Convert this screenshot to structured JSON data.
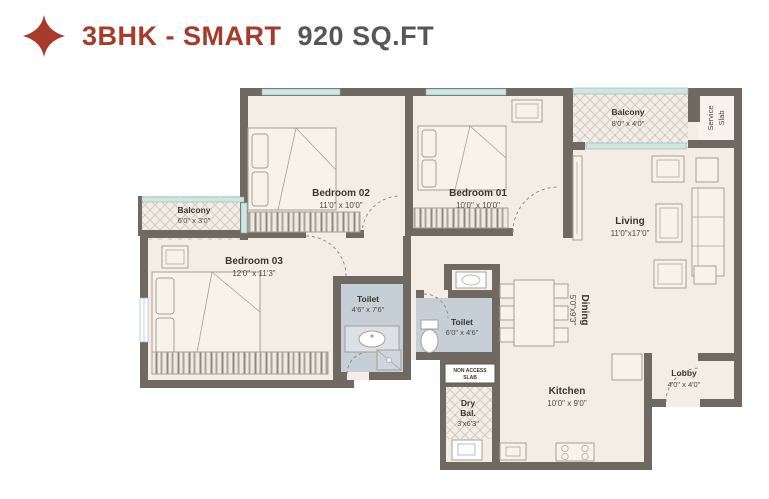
{
  "header": {
    "title_primary": "3BHK - SMART",
    "title_secondary": "920 SQ.FT",
    "accent_color": "#A63A2B",
    "secondary_text_color": "#55565A",
    "logo_icon": "sparkle-diamond"
  },
  "floorplan": {
    "colors": {
      "wall": "#6f6962",
      "floor": "#f4ede6",
      "toilet_floor": "#c6cfd6",
      "window": "#cfe6e3",
      "furniture_line": "#a79f94"
    },
    "rooms": {
      "bedroom02": {
        "name": "Bedroom 02",
        "dim": "11'0\" x 10'0\""
      },
      "bedroom01": {
        "name": "Bedroom 01",
        "dim": "10'0\" x 10'0\""
      },
      "bedroom03": {
        "name": "Bedroom 03",
        "dim": "12'0\" x 11'3\""
      },
      "living": {
        "name": "Living",
        "dim": "11'0\"x17'0\""
      },
      "dining": {
        "name": "Dining",
        "dim": "5'0\"x9'3\""
      },
      "kitchen": {
        "name": "Kitchen",
        "dim": "10'0\" x 9'0\""
      },
      "toilet1": {
        "name": "Toilet",
        "dim": "4'6\" x 7'6\""
      },
      "toilet2": {
        "name": "Toilet",
        "dim": "6'0\" x 4'6\""
      },
      "balcony_left": {
        "name": "Balcony",
        "dim": "6'0\" x 3'0\""
      },
      "balcony_top": {
        "name": "Balcony",
        "dim": "8'0\" x 4'0\""
      },
      "lobby": {
        "name": "Lobby",
        "dim": "4'0\" x 4'0\""
      },
      "dry_balcony": {
        "line1": "Dry",
        "line2": "Bal.",
        "dim": "3'x6'3\""
      },
      "service_slab": {
        "line1": "Service",
        "line2": "Slab"
      },
      "non_access": {
        "line1": "NON ACCESS",
        "line2": "SLAB"
      }
    }
  }
}
